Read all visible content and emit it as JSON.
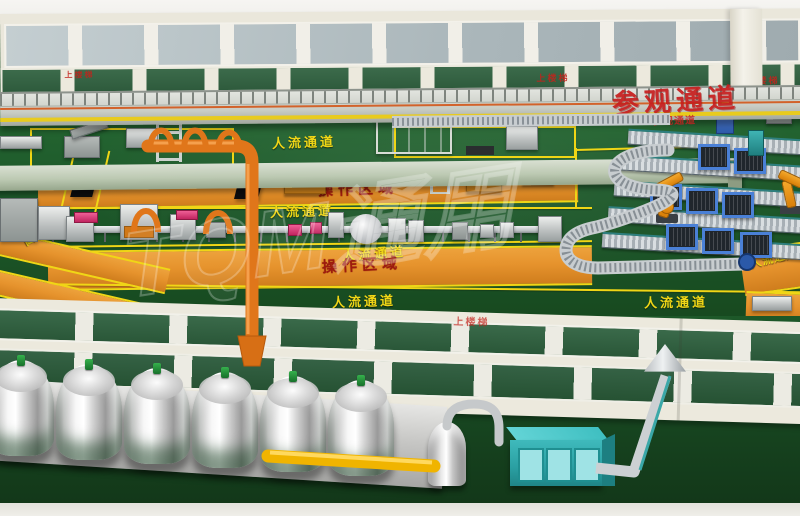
{
  "signs": {
    "visitor_walkway": "参观通道",
    "operation_area": "操作区域",
    "pedestrian_lane": "人流通道",
    "stairs": "上楼梯"
  },
  "watermark": "TQM通用",
  "colors": {
    "floor_green": "#1e5b2c",
    "lane_yellow": "#f0d616",
    "operation_orange": "#e6932d",
    "pipe_orange": "#e0761a",
    "sign_red": "#c71f1f",
    "operation_label_red": "#9e1b0e",
    "wall_cream": "#eae7db",
    "window_green": "#2e5f3e",
    "window_gray": "#b6c1c5",
    "walkway_gray": "#c9cdc5",
    "beam_sage": "#bcc9b2",
    "tank_silver": "#d9d9d9",
    "teal_unit": "#32aeb0",
    "pallet_blue": "#4a80d6",
    "robot_orange": "#e8930f",
    "yellow_pipe": "#f0b400"
  }
}
